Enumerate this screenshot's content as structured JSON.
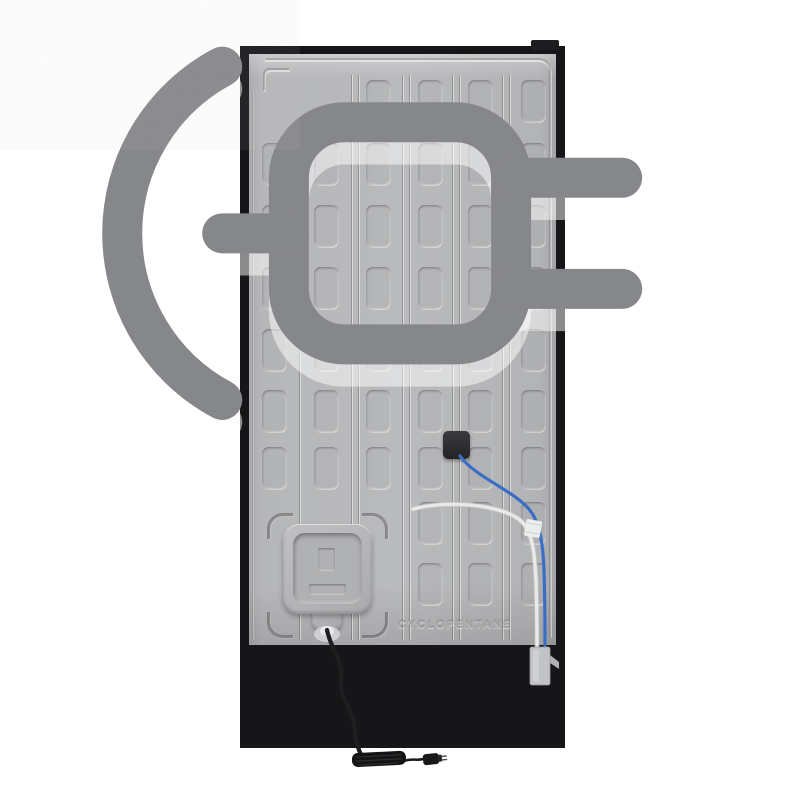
{
  "scene": {
    "subject": "refrigerator back panel",
    "background_color": "#ffffff"
  },
  "labels": {
    "embossed_text": "CYCLOPENTANE"
  },
  "colors": {
    "panel_gray": "#b6b7b9",
    "lower_section_gray": "#a7a8aa",
    "frame_black": "#161618",
    "junction_box_black": "#2e2e30",
    "wire_blue": "#3a6ec6",
    "tube_white": "#e9e9ea",
    "cord_black": "#1e1e20",
    "vent_slot_dark": "#2c2c2e"
  },
  "back_panel": {
    "pattern": {
      "cell_w": 25,
      "cell_h": 43,
      "col_x": [
        262,
        314,
        366,
        418,
        468,
        521
      ],
      "row_y": [
        80,
        143,
        205,
        267,
        329,
        390,
        447,
        502,
        563
      ],
      "rows": [
        [
          2,
          3,
          4,
          5
        ],
        [
          0,
          1,
          2,
          3,
          4,
          5
        ],
        [
          0,
          1,
          2,
          3,
          4,
          5
        ],
        [
          0,
          1,
          2,
          3,
          4,
          5
        ],
        [
          0,
          1,
          2,
          3,
          4,
          5
        ],
        [
          0,
          1,
          2,
          3,
          4,
          5
        ],
        [
          0,
          1,
          2,
          3,
          4,
          5
        ],
        [
          3,
          4,
          5
        ],
        [
          3,
          4,
          5
        ]
      ],
      "grooves": [
        {
          "x": 299,
          "y1": 140,
          "y2": 640
        },
        {
          "x": 351,
          "y1": 75,
          "y2": 640
        },
        {
          "x": 358,
          "y1": 75,
          "y2": 640
        },
        {
          "x": 402,
          "y1": 75,
          "y2": 640
        },
        {
          "x": 409,
          "y1": 75,
          "y2": 640
        },
        {
          "x": 452,
          "y1": 75,
          "y2": 640
        },
        {
          "x": 459,
          "y1": 75,
          "y2": 640
        },
        {
          "x": 502,
          "y1": 75,
          "y2": 640
        },
        {
          "x": 509,
          "y1": 75,
          "y2": 640
        }
      ]
    }
  },
  "vents": {
    "left": {
      "rows": 3,
      "slats_per_row": 8
    },
    "center": {
      "columns": 2,
      "slats_per_column": 11
    },
    "right": {
      "rows": [
        2,
        4,
        4
      ]
    }
  },
  "base": {
    "clip_positions_x": [
      288,
      393,
      525
    ]
  }
}
